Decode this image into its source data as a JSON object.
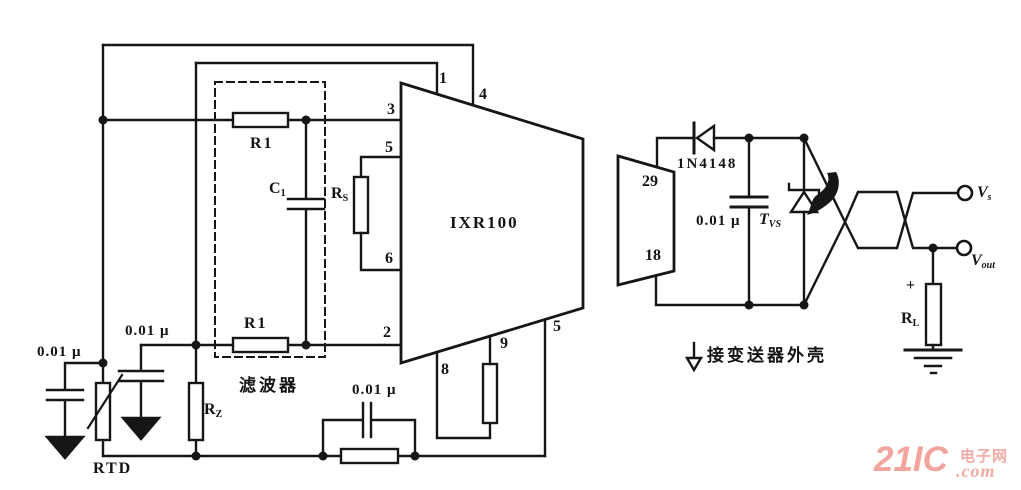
{
  "ic": {
    "name": "IXR100",
    "pins": {
      "p1": "1",
      "p4": "4",
      "p3": "3",
      "p5_left": "5",
      "p6": "6",
      "p2": "2",
      "p8": "8",
      "p9": "9",
      "p5_bottom": "5"
    }
  },
  "connector": {
    "pin_top": "29",
    "pin_bottom": "18"
  },
  "filter": {
    "caption": "滤波器",
    "r_top": "R1",
    "r_bottom": "R1",
    "cap": {
      "main": "C",
      "sub": "1"
    }
  },
  "components": {
    "cap_far_left": "0.01 μ",
    "cap_left": "0.01 μ",
    "cap_bottom": "0.01 μ",
    "cap_right": "0.01 μ",
    "rtd": "RTD",
    "rz": {
      "main": "R",
      "sub": "Z"
    },
    "rs": {
      "main": "R",
      "sub": "S"
    },
    "rl": {
      "main": "R",
      "sub": "L"
    },
    "rl_polarity": "+",
    "tvs": {
      "main": "T",
      "sub": "VS"
    },
    "diode": "1N4148"
  },
  "outputs": {
    "vs": {
      "main": "V",
      "sub": "s"
    },
    "vout": {
      "main": "V",
      "sub": "out"
    }
  },
  "annotations": {
    "chassis_note": "接变送器外壳"
  },
  "watermark": {
    "brand": "21IC",
    "suffix_top": "电子网",
    "suffix_bottom": ".com"
  },
  "colors": {
    "ink": "#161616",
    "watermark_pink": "#f2a49e"
  }
}
